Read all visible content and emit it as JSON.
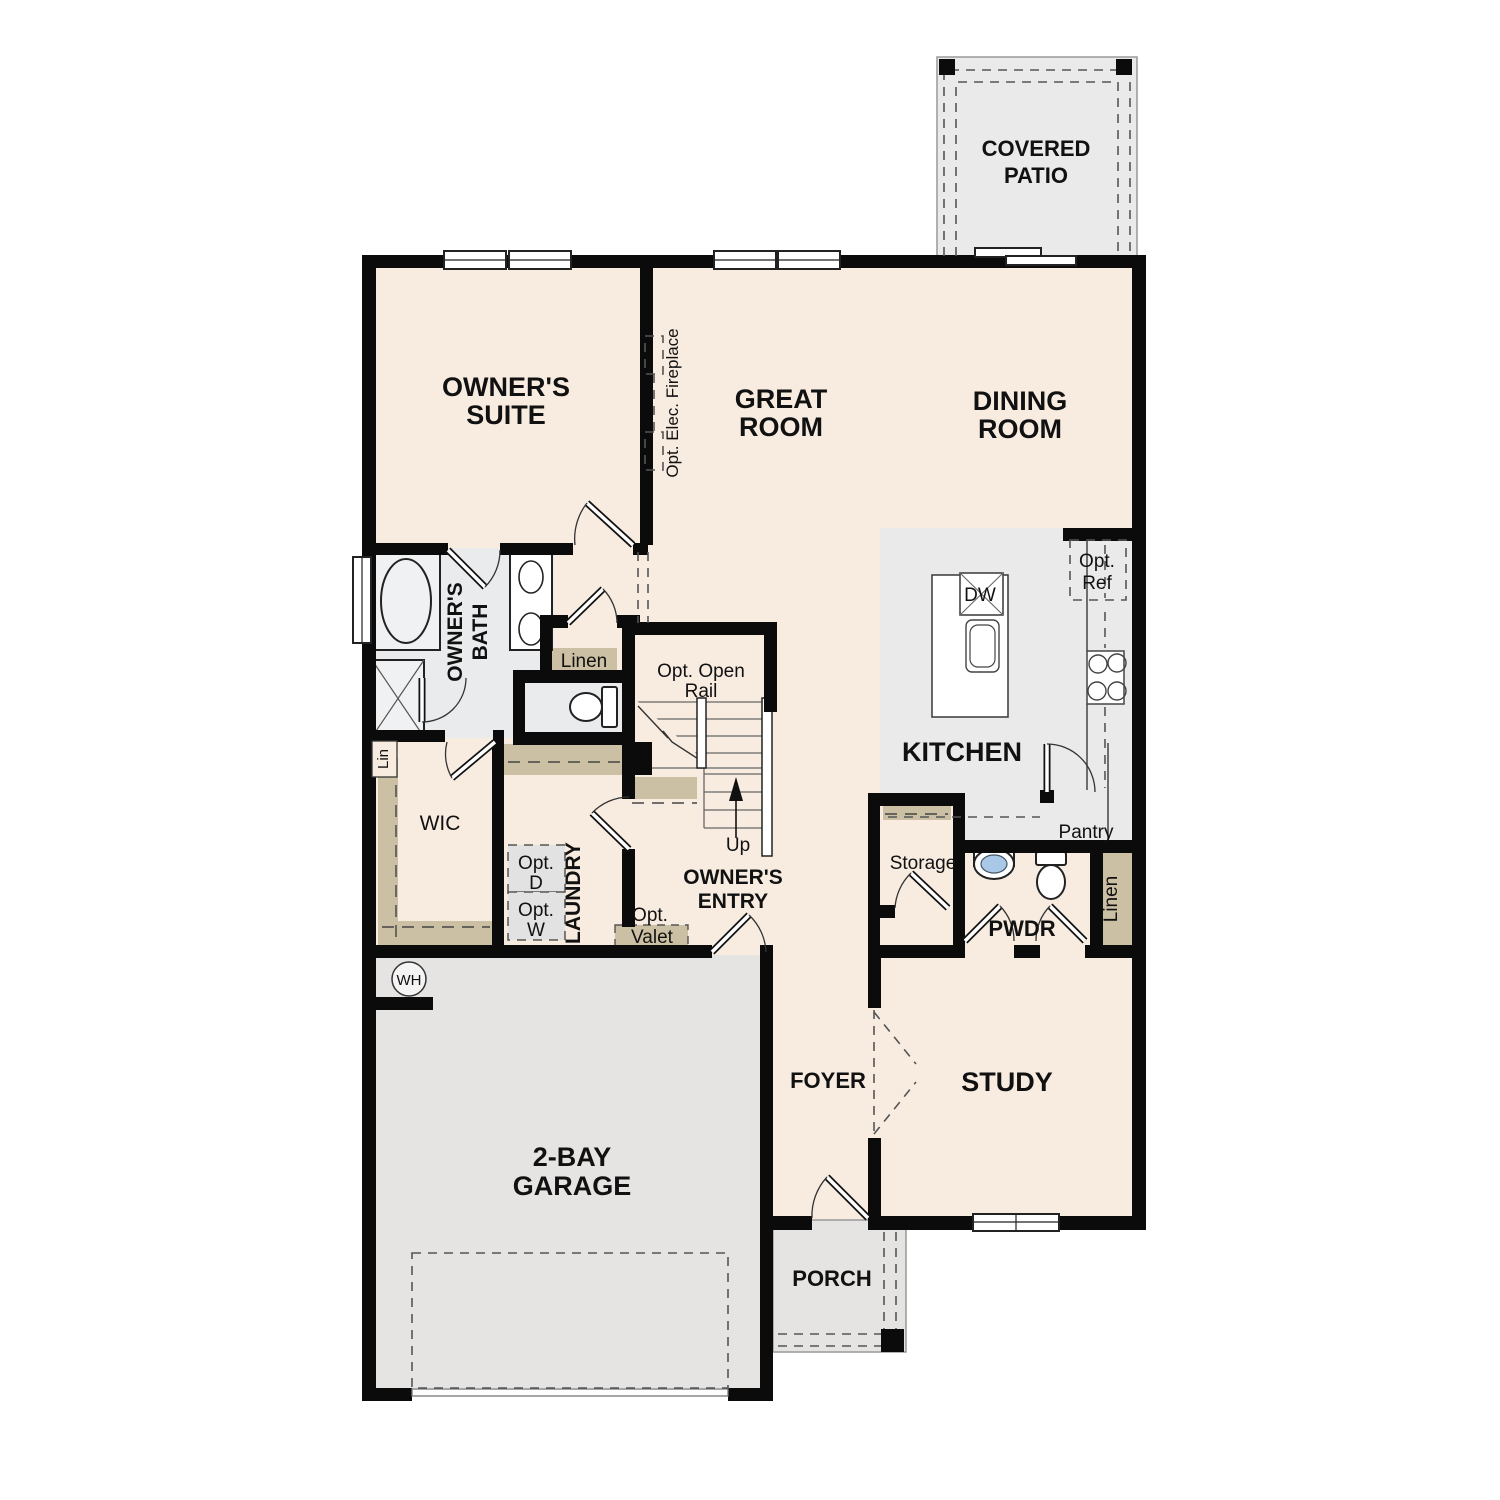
{
  "plan_type": "single-story floor plan",
  "colors": {
    "floor_cream": "#f8ece1",
    "outdoor_gray": "#e6e4e2",
    "kitchen_gray": "#eaeaea",
    "bath_gray": "#e9ebec",
    "closet_tan": "#ccc0a4",
    "wall_black": "#0b0b0b",
    "sink_blue": "#a9c7e6"
  },
  "rooms": {
    "covered_patio": {
      "line1": "COVERED",
      "line2": "PATIO"
    },
    "owners_suite": {
      "line1": "OWNER'S",
      "line2": "SUITE"
    },
    "great_room": {
      "line1": "GREAT",
      "line2": "ROOM"
    },
    "dining_room": {
      "line1": "DINING",
      "line2": "ROOM"
    },
    "owners_bath": {
      "line1": "OWNER'S",
      "line2": "BATH"
    },
    "kitchen": {
      "label": "KITCHEN"
    },
    "wic": {
      "label": "WIC"
    },
    "laundry": {
      "label": "LAUNDRY"
    },
    "owners_entry": {
      "line1": "OWNER'S",
      "line2": "ENTRY"
    },
    "pwdr": {
      "label": "PWDR"
    },
    "storage": {
      "label": "Storage"
    },
    "pantry": {
      "label": "Pantry"
    },
    "foyer": {
      "label": "FOYER"
    },
    "study": {
      "label": "STUDY"
    },
    "garage": {
      "line1": "2-BAY",
      "line2": "GARAGE"
    },
    "porch": {
      "label": "PORCH"
    }
  },
  "annotations": {
    "opt_elec_fireplace": "Opt. Elec. Fireplace",
    "opt_open_rail_1": "Opt. Open",
    "opt_open_rail_2": "Rail",
    "up": "Up",
    "linen_bath": "Linen",
    "lin_closet": "Lin",
    "linen_hall": "Linen",
    "opt_d_1": "Opt.",
    "opt_d_2": "D",
    "opt_w_1": "Opt.",
    "opt_w_2": "W",
    "opt_valet_1": "Opt.",
    "opt_valet_2": "Valet",
    "opt_ref_1": "Opt.",
    "opt_ref_2": "Ref",
    "dishwasher": "DW",
    "water_heater": "WH"
  }
}
